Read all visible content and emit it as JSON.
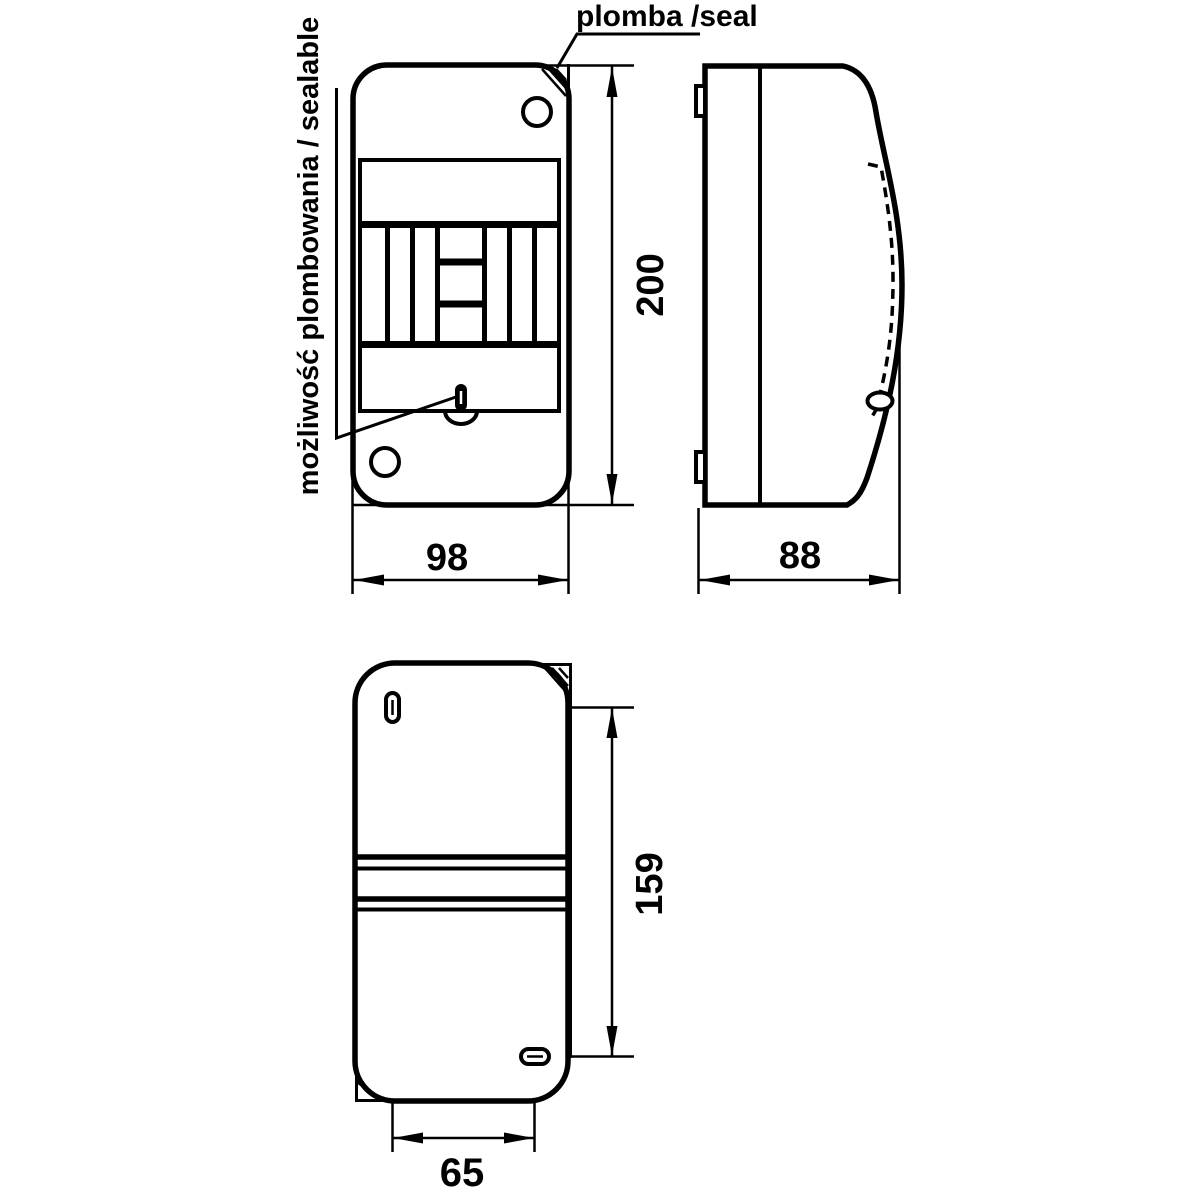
{
  "drawing": {
    "background_color": "#ffffff",
    "line_color": "#000000",
    "annotations": {
      "seal_label": "plomba /seal",
      "sealable_label": "możliwość plombowania / sealable"
    },
    "dimensions": {
      "front_height_mm": "200",
      "front_width_mm": "98",
      "side_depth_mm": "88",
      "back_slot_vertical_spacing_mm": "159",
      "back_slot_horizontal_spacing_mm": "65"
    }
  }
}
